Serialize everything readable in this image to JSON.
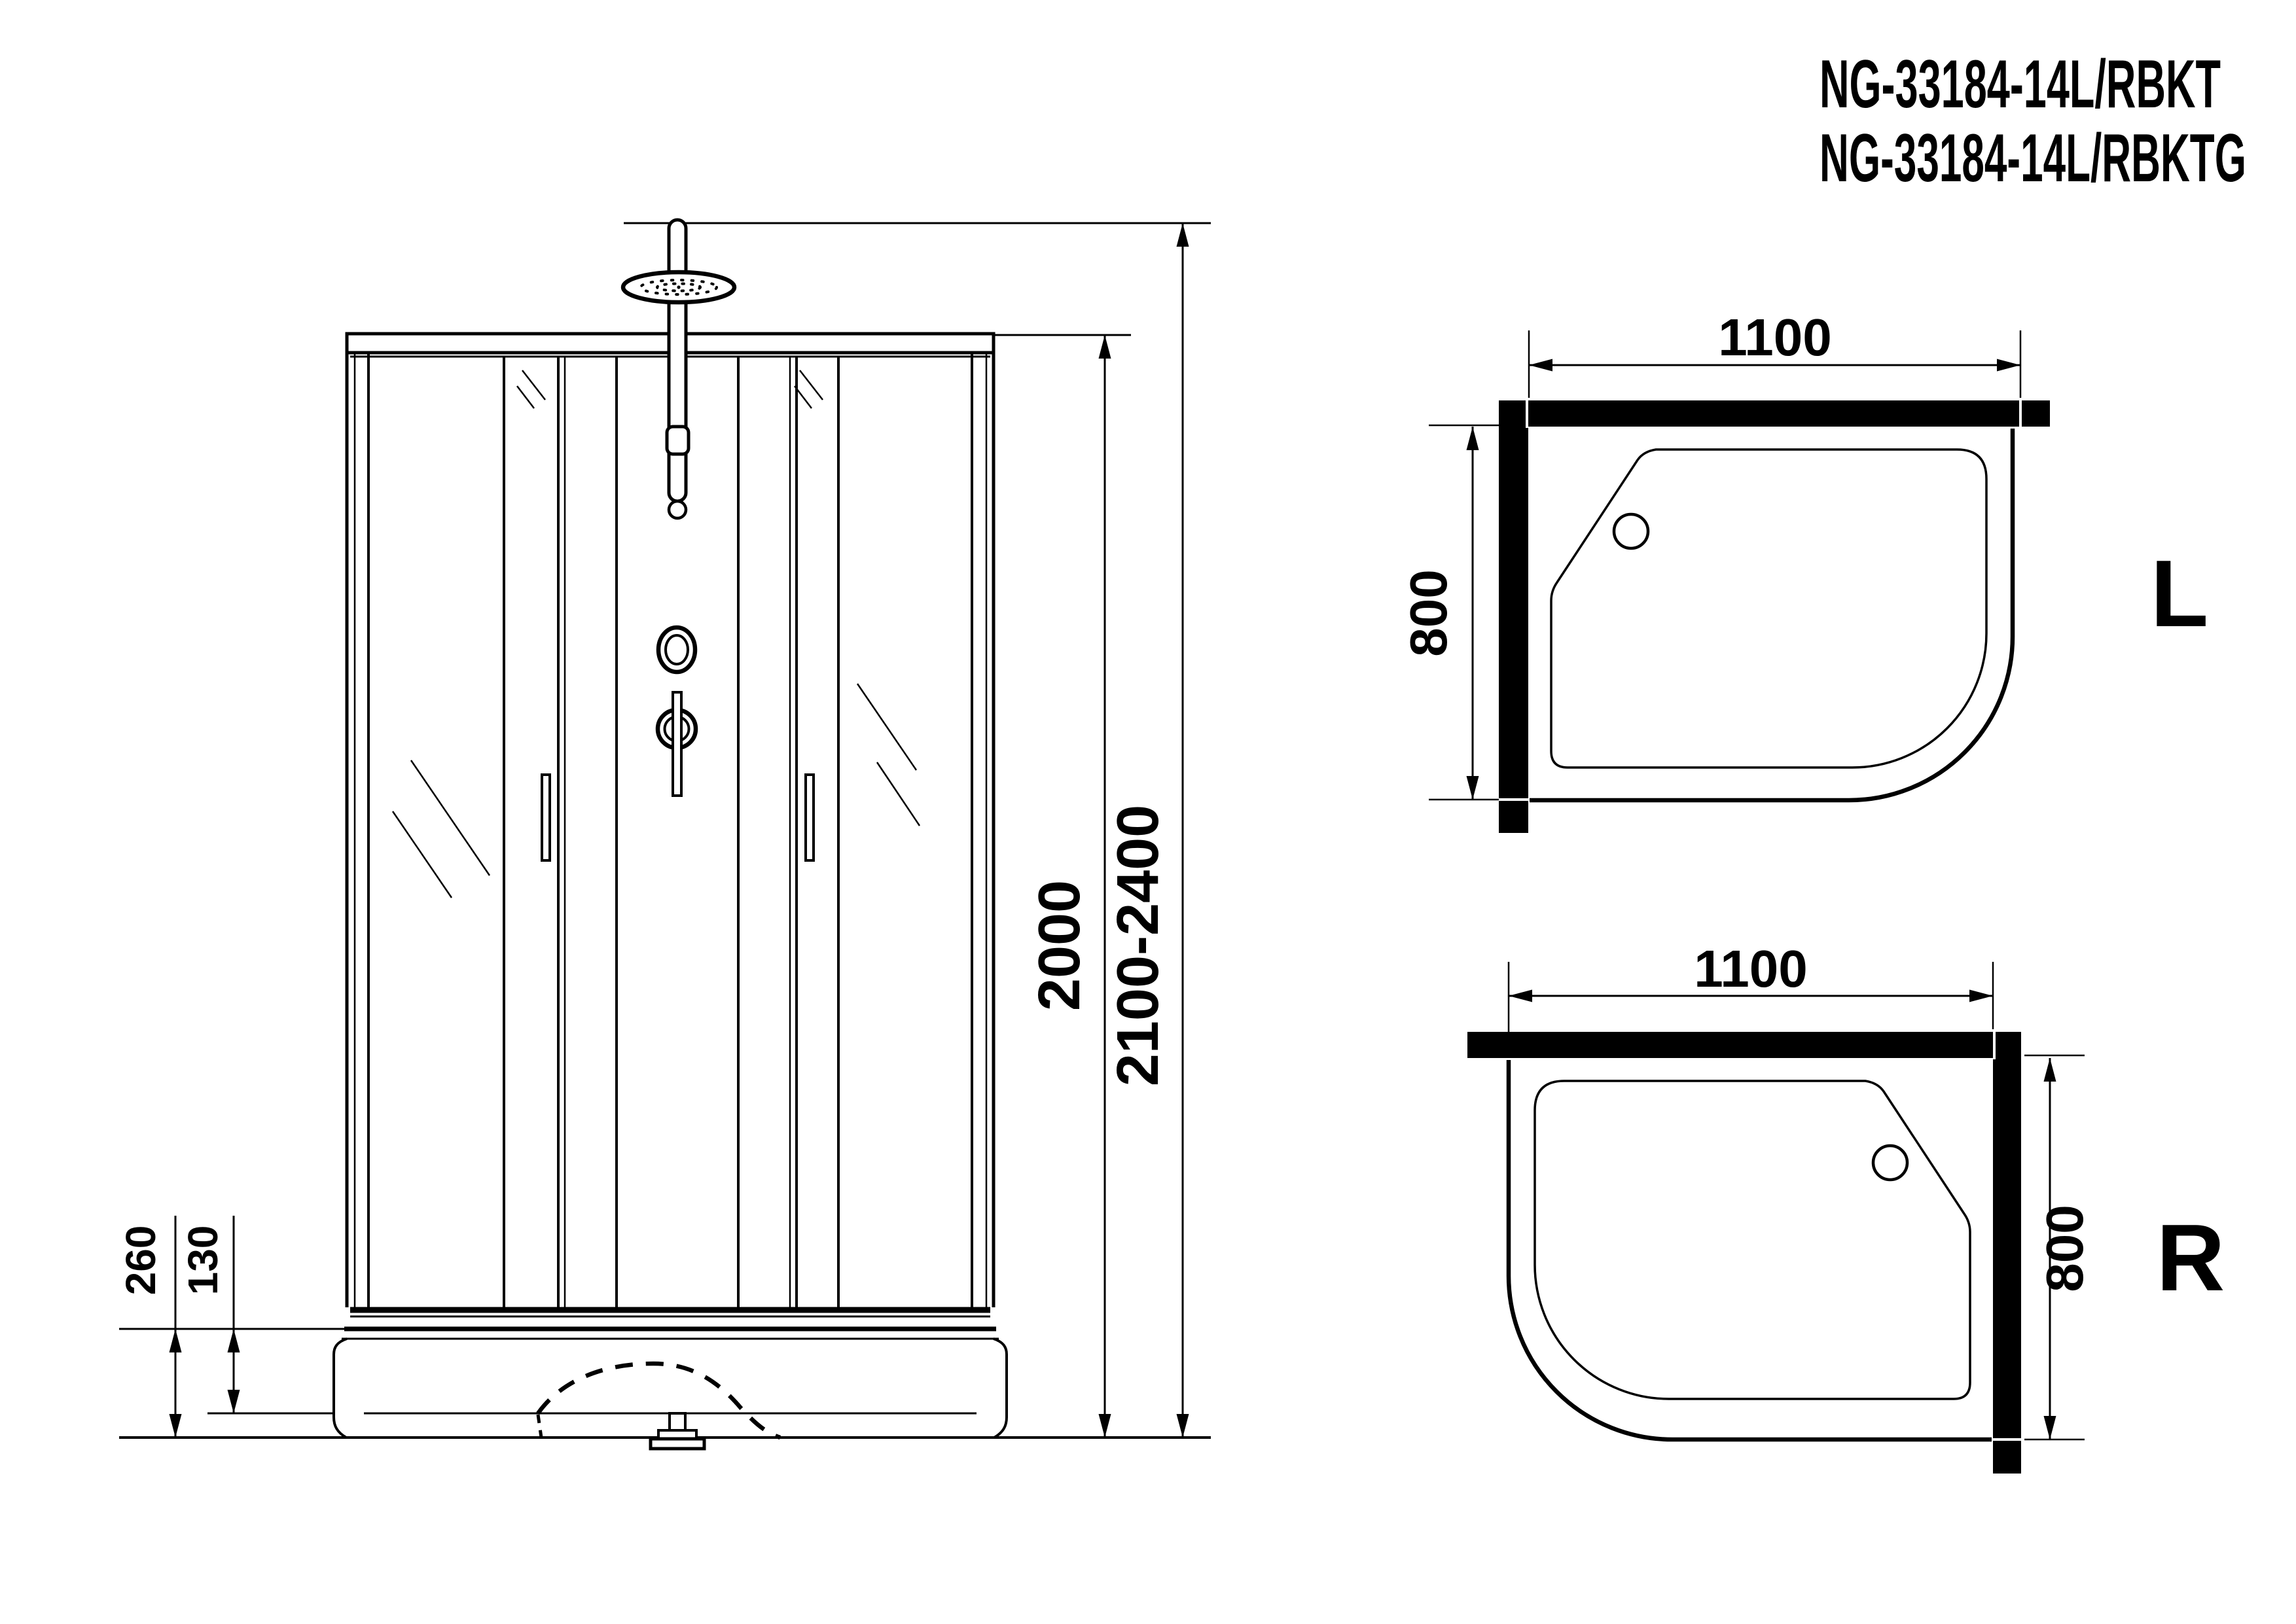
{
  "title": {
    "line1": "NG-33184-14L/RBKT",
    "line2": "NG-33184-14L/RBKTG"
  },
  "front_view": {
    "dim_height": "2000",
    "dim_height_total": "2100-2400",
    "dim_tray_height": "260",
    "dim_tray_inner_height": "130"
  },
  "plan_left": {
    "dim_width": "1100",
    "dim_depth": "800",
    "orientation_label": "L"
  },
  "plan_right": {
    "dim_width": "1100",
    "dim_depth": "800",
    "orientation_label": "R"
  },
  "colors": {
    "background": "#ffffff",
    "line": "#000000",
    "wall_fill": "#000000"
  }
}
